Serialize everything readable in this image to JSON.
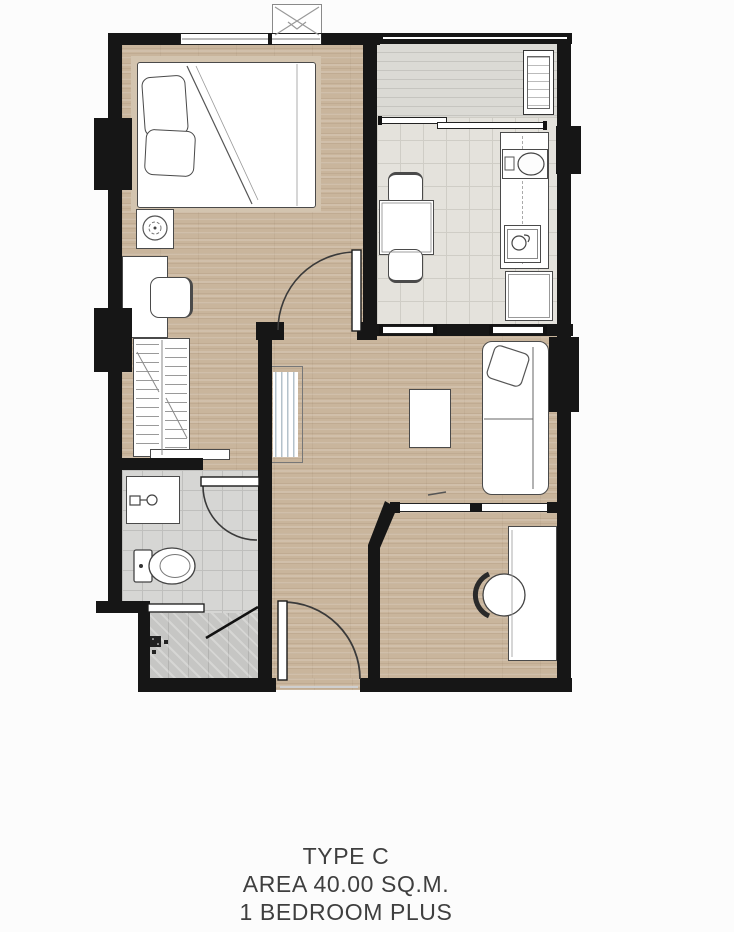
{
  "title_block": {
    "line1": "TYPE C",
    "line2": "AREA 40.00 SQ.M.",
    "line3": "1 BEDROOM PLUS"
  },
  "colors": {
    "wall": "#161616",
    "wood": "#c9b59c",
    "tile": "#e4e2dc",
    "tileline": "#cfcdc6",
    "balcony": "#dbdad5",
    "bath": "#d6d6d4",
    "showerc": "#c6c6c4",
    "line": "#4a4a4a"
  },
  "furniture_legend": [
    "double-bed",
    "pillows",
    "nightstand",
    "plant",
    "vanity-desk",
    "vanity-chair",
    "wardrobe",
    "washbasin",
    "toilet",
    "shower-screen",
    "floor-drain",
    "dining-table",
    "dining-chair",
    "kitchen-counter",
    "kitchen-sink",
    "cooktop",
    "refrigerator",
    "balcony-ac-condenser",
    "roof-ac-condenser",
    "sofa",
    "sofa-cushion",
    "coffee-table",
    "tv-panel",
    "work-desk",
    "desk-chair",
    "entrance-door",
    "bedroom-door",
    "bathroom-door",
    "sliding-partition",
    "sliding-glass-door",
    "window",
    "balcony-railing"
  ]
}
